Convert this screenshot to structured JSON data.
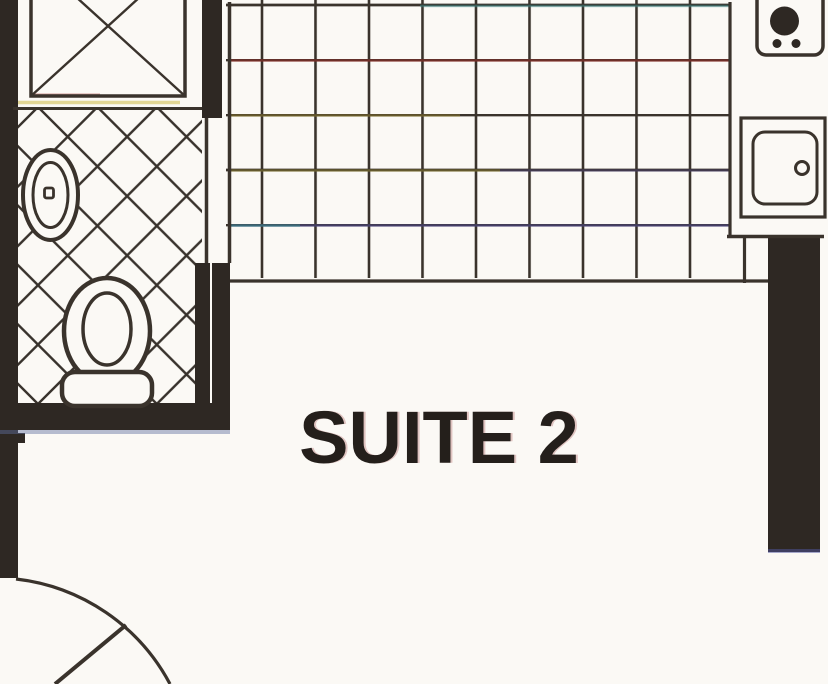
{
  "plan": {
    "room_label": "SUITE 2",
    "fixtures": [
      {
        "name": "shower-stall",
        "symbol": "square-with-x"
      },
      {
        "name": "lavatory-sink",
        "symbol": "oval-basin-with-drain"
      },
      {
        "name": "toilet",
        "symbol": "bowl-with-tank"
      },
      {
        "name": "range-burner",
        "symbol": "burner-circle-with-two-knobs"
      },
      {
        "name": "kitchen-sink",
        "symbol": "rounded-square-basin-with-drain"
      },
      {
        "name": "door-swing",
        "symbol": "quarter-arc-with-leaf"
      }
    ],
    "floor_finishes": [
      {
        "name": "bathroom-floor",
        "pattern": "diagonal-crosshatch-tile"
      },
      {
        "name": "main-floor",
        "pattern": "square-tile-grid"
      }
    ]
  },
  "colors": {
    "paper": "#fbf9f5",
    "ink": "#3a332c",
    "wall": "#2e2823",
    "label": "#241f1b"
  }
}
